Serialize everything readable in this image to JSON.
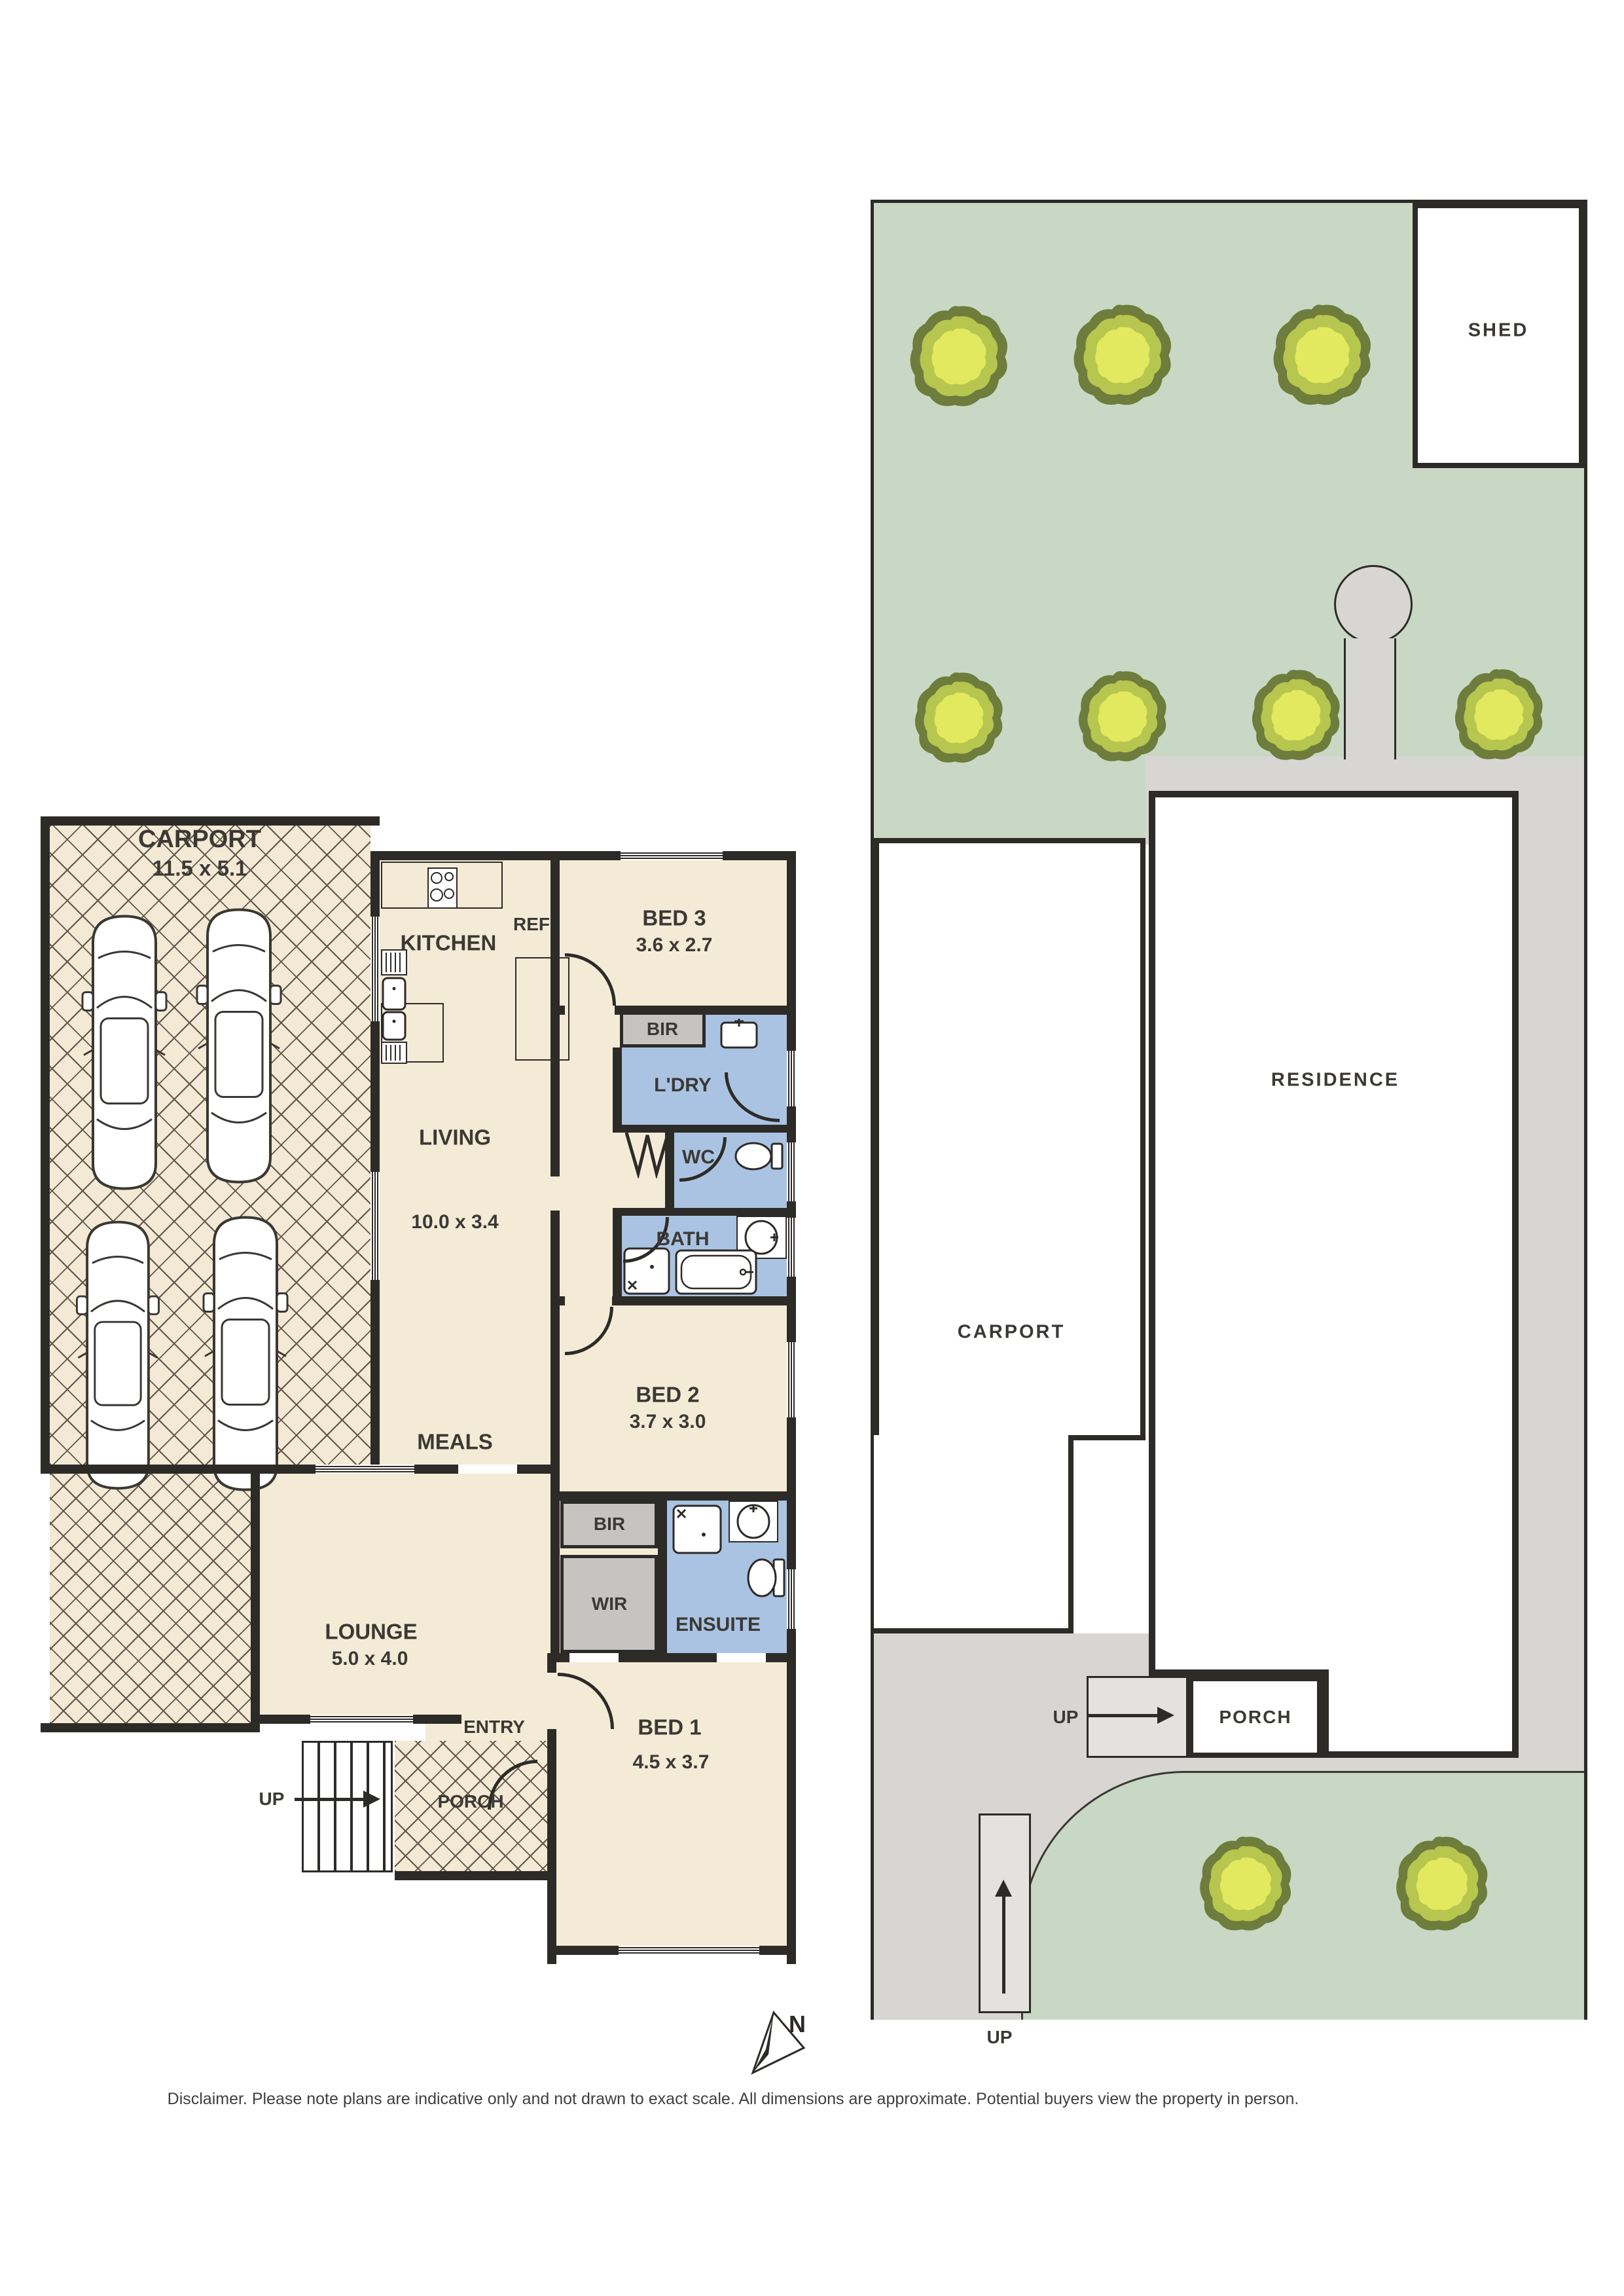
{
  "floorplan": {
    "carport": {
      "label": "CARPORT",
      "dims": "11.5 x 5.1"
    },
    "kitchen": {
      "label": "KITCHEN",
      "ref": "REF"
    },
    "bed3": {
      "label": "BED 3",
      "dims": "3.6 x 2.7"
    },
    "bir1": "BIR",
    "ldry": "L'DRY",
    "wc": "WC",
    "bath": "BATH",
    "living": {
      "label": "LIVING",
      "dims": "10.0 x 3.4"
    },
    "meals": "MEALS",
    "bed2": {
      "label": "BED 2",
      "dims": "3.7 x 3.0"
    },
    "bir2": "BIR",
    "wir": "WIR",
    "ensuite": "ENSUITE",
    "bed1": {
      "label": "BED 1",
      "dims": "4.5 x 3.7"
    },
    "lounge": {
      "label": "LOUNGE",
      "dims": "5.0 x 4.0"
    },
    "entry": "ENTRY",
    "porch": "PORCH",
    "stairs": {
      "label": "UP"
    }
  },
  "siteplan": {
    "shed": "SHED",
    "carport": "CARPORT",
    "residence": "RESIDENCE",
    "porch": "PORCH",
    "stairs_side": {
      "label": "UP"
    },
    "stairs_front": {
      "label": "UP"
    }
  },
  "compass": {
    "label": "N"
  },
  "disclaimer": "Disclaimer. Please note plans are indicative only and not drawn to exact scale. All dimensions are approximate. Potential buyers view the property in person.",
  "colors": {
    "wall": "#2d2b28",
    "floor_cream": "#f4ebd6",
    "wet_blue": "#aac3e2",
    "robe_gray": "#c6c3c0",
    "site_green": "#c9d8c5",
    "path_gray": "#d7d6d3",
    "tree_outer": "#6e7c3c",
    "tree_mid": "#b6c64e",
    "tree_inner": "#e2e95e"
  }
}
